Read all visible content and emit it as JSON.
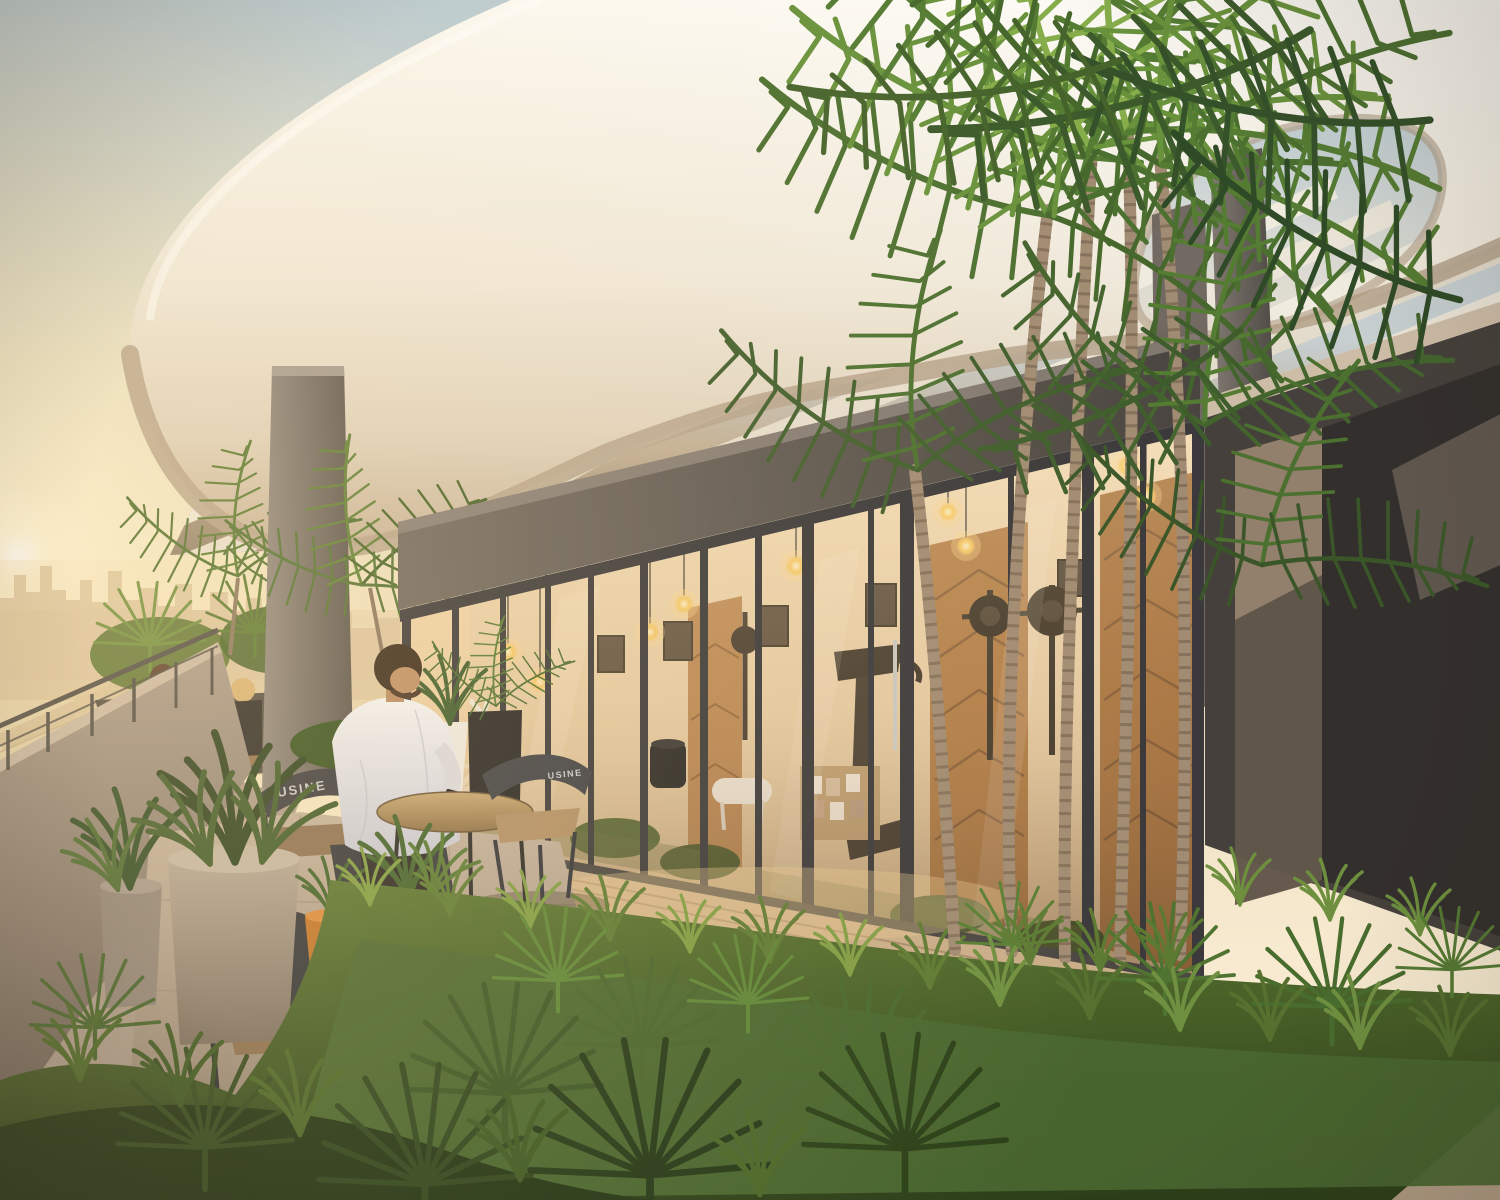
{
  "meta": {
    "type": "architectural-rendering",
    "description": "Sunset rooftop terrace of a residential tower: sculptural white curved canopy with pergola slats, glass-walled gym pavilion with warm pendant lighting, lush tropical garden with areca palms, a man seated at a cafe table using his phone, a couple on a bench, hazy city skyline behind a parapet railing.",
    "width_px": 1500,
    "height_px": 1200,
    "time_of_day": "sunset"
  },
  "scene": {
    "visible_text": {
      "chair_back_left": "USINE",
      "chair_back_right": "USINE"
    },
    "entities": [
      {
        "name": "curved-canopy",
        "desc": "organic white sculptural roof band with oval skylight cutout"
      },
      {
        "name": "pergola-slats",
        "desc": "parallel white beams under the canopy"
      },
      {
        "name": "gym-pavilion",
        "desc": "glass-walled fitness room with dark concrete fascia"
      },
      {
        "name": "pendant-bulbs",
        "desc": "warm Edison bulbs hanging inside the gym"
      },
      {
        "name": "wood-chevron-panels",
        "desc": "timber herringbone wall panels inside gym"
      },
      {
        "name": "gym-equipment",
        "desc": "elliptical trainer, barbell stands, treadmill, white bench, shelf with photos"
      },
      {
        "name": "concrete-columns",
        "desc": "grey columns supporting the canopy"
      },
      {
        "name": "city-skyline",
        "desc": "hazy high-rise skyline at golden hour with highway below"
      },
      {
        "name": "sun",
        "desc": "low sun glowing at left horizon"
      },
      {
        "name": "parapet-railing",
        "desc": "edge wall with thin metal guardrail"
      },
      {
        "name": "man-at-table",
        "desc": "man in white t-shirt seated, looking at phone"
      },
      {
        "name": "background-couple",
        "desc": "two people seated on a wooden bench among plants"
      },
      {
        "name": "cafe-table-and-chairs",
        "desc": "round wooden table with curved-back metal chairs, tan cushions"
      },
      {
        "name": "planters",
        "desc": "concrete pots, orange pot, black wire-stand planter, white and black planters"
      },
      {
        "name": "areca-palm-cluster",
        "desc": "tall multi-trunk palms in the garden"
      },
      {
        "name": "tropical-garden",
        "desc": "dense grasses, fan palms and ferns across the foreground"
      },
      {
        "name": "right-building-wall",
        "desc": "dark concrete volume at right"
      }
    ]
  },
  "palette": {
    "sky_top": "#b9cbd3",
    "sky_warm": "#f7ead0",
    "sunset_glow": "#fff7da",
    "sun_core": "#ffffff",
    "canopy_white": "#f6f2ea",
    "canopy_underside": "#b5a28b",
    "slat_white": "#f0ebdf",
    "soffit_shadow": "#8e7d6a",
    "concrete_column": "#6b635c",
    "fascia_dark": "#4e4843",
    "glass_warm": "#e8cfa8",
    "interior_glow": "#ffe9b8",
    "wood_panel": "#a9743f",
    "deck_wood": "#c9ad89",
    "paver": "#b3a191",
    "grass_light": "#7f9c43",
    "grass_dark": "#2c4019",
    "palm_green": "#4c7030",
    "palm_trunk": "#a18b72",
    "chair_metal": "#3a3b40",
    "cushion_tan": "#b08e66",
    "shirt_white": "#eceaf0",
    "pot_concrete": "#a99c8d",
    "pot_orange": "#c0742b",
    "planter_black": "#262525",
    "right_wall": "#45403b"
  }
}
